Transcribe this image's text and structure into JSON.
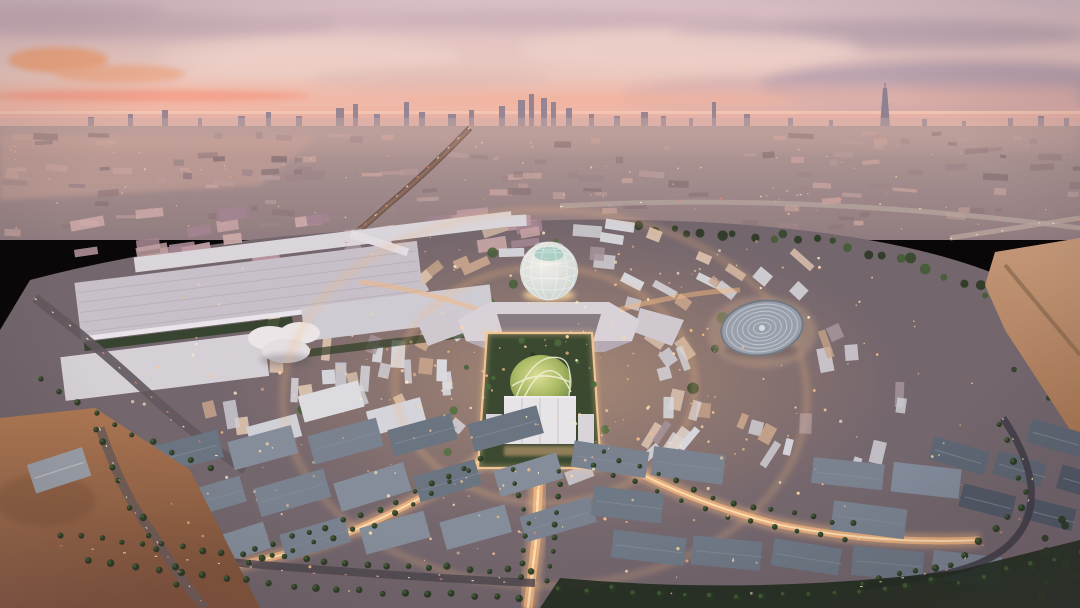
{
  "scene": {
    "description": "Dusk aerial rendering of the Expo 2020 Dubai master plan: a circular illuminated site with the Al Wasl lattice dome and central glowing lawn plaza, a round arena disc, large exhibition halls on the left, palm-lined boulevards, desert at the edges and the hazy Dubai skyline with the Burj Khalifa spire on the pink sunset horizon.",
    "palette": {
      "sky_top": "#d9c0c7",
      "sky_mid": "#ecc9c0",
      "sky_peach": "#f2b7a4",
      "sky_horizon": "#efb3a0",
      "cloud_mauve": "#c2a9b4",
      "cloud_dark": "#ab98ab",
      "cloud_light": "#efd3ca",
      "cloud_gray": "#d9b7b2",
      "glow_orange": "#f2a173",
      "glow_streak": "#f59e87",
      "sea": "#e7b2a7",
      "sea_light": "#f6c9b4",
      "skyline": "#8b7f90",
      "skyline_haze": "#c9aeab",
      "mid_top": "#b39a97",
      "mid_bottom": "#8d7a7e",
      "mid_block_light": "#b79c99",
      "mid_block_dark": "#8b7578",
      "mid_pink": "#c59e95",
      "site_base": "#6f636b",
      "site_glow": "#c79b76",
      "roof_white": "#d9dbe1",
      "roof_light": "#cfd0d8",
      "roof_cream": "#d8c0ab",
      "roof_warm": "#c8a58b",
      "roof_mauve": "#a5939b",
      "slate_roof": "#76818f",
      "slate_dark": "#4d5663",
      "slate_light": "#828c9a",
      "palm_dark": "#24351f",
      "palm_mid": "#3d5a31",
      "courtyard_green": "#3f5c33",
      "lawn_light": "#dce294",
      "lawn_mid": "#a4b75e",
      "lawn_dark": "#6f8a45",
      "garden": "#33452b",
      "dome_light": "#f4f2ec",
      "dome_edge": "#c6d3d0",
      "dome_teal": "#9fccc2",
      "arena_base": "#97a0ab",
      "arena_rim": "#6e7781",
      "arena_ring": "#c6cdd5",
      "avenue_glow": "#f4b77e",
      "avenue_core": "#ffe2b2",
      "frame_glow": "#f8c892",
      "light_warm": "#ffd8a4",
      "light_amber": "#ffc084",
      "light_bright": "#fff1cc",
      "car_white": "#ffe8c6",
      "car_red": "#ff8a6a",
      "sand_light": "#b07a52",
      "sand_dark": "#80533a",
      "sand_pink": "#c29676",
      "hall_roof": "#c7c1c9",
      "hall_roof2": "#d5d2d8",
      "hall_edge": "#e9e6ec",
      "pavilion_white": "#ece8ea",
      "road_dark": "#4a444c",
      "pentagon_roof": "#d8d3d9",
      "pentagon_court": "#857a82",
      "pentagon_face": "#b3aab3",
      "plaza_building": "#e8e6ea"
    },
    "counts": {
      "seed": 7,
      "midground_blocks": 150,
      "midground_lights": 85,
      "edge_blocks": 30,
      "site_blocks": 100,
      "site_courtyards": 22,
      "site_lights": 280
    }
  }
}
